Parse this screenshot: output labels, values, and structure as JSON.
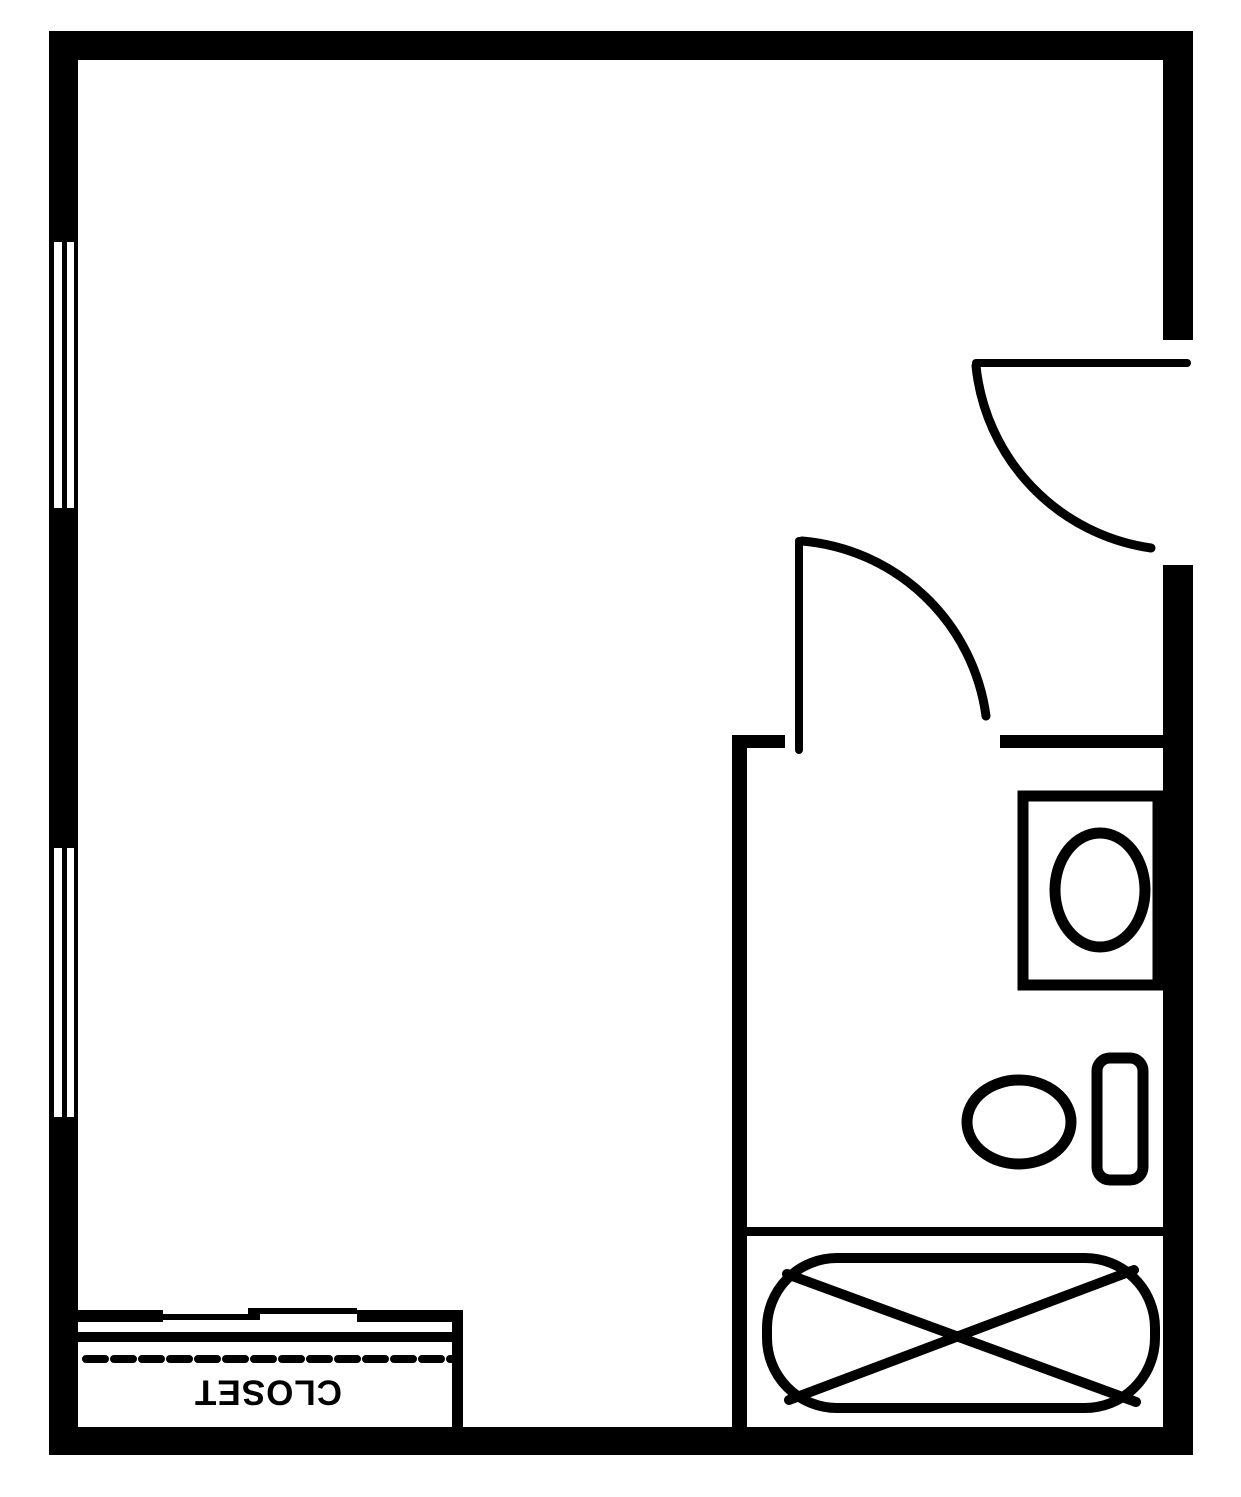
{
  "diagram": {
    "type": "floor-plan",
    "labels": {
      "closet": "CLOSET"
    },
    "colors": {
      "line": "#000000",
      "background": "#ffffff"
    },
    "elements": [
      "outer-walls",
      "window-upper",
      "window-lower",
      "entry-door",
      "bathroom-door",
      "bathroom-walls",
      "vanity-sink",
      "toilet",
      "bathtub",
      "closet-bypass-door",
      "closet-shelf-line",
      "closet-label"
    ]
  }
}
